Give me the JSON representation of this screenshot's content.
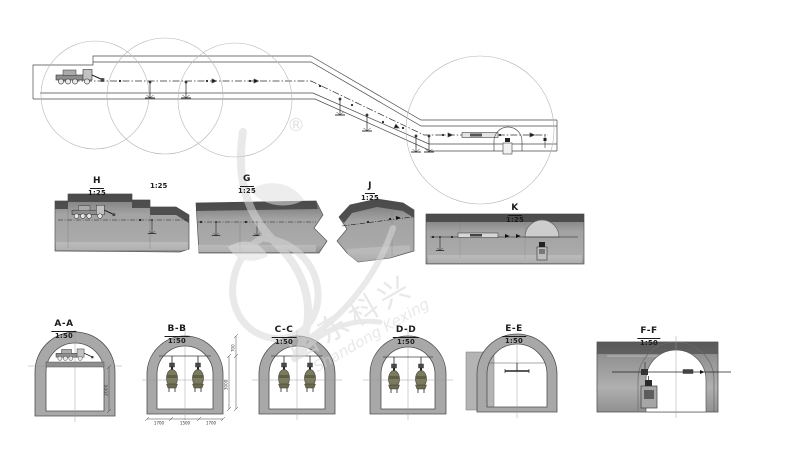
{
  "watermark": {
    "registered_mark": "®",
    "brand_cn": "山东科兴",
    "brand_en": "Shandong Kexing"
  },
  "detail_views": [
    {
      "label": "H",
      "scale": "1:25"
    },
    {
      "label": "G",
      "scale": "1:25"
    },
    {
      "label": "J",
      "scale": "1:25"
    },
    {
      "label": "K",
      "scale": "1:25"
    }
  ],
  "floating_scale": "1:25",
  "cross_sections": [
    {
      "label": "A-A",
      "scale": "1:50"
    },
    {
      "label": "B-B",
      "scale": "1:50"
    },
    {
      "label": "C-C",
      "scale": "1:50"
    },
    {
      "label": "D-D",
      "scale": "1:50"
    },
    {
      "label": "E-E",
      "scale": "1:50"
    },
    {
      "label": "F-F",
      "scale": "1:50"
    }
  ],
  "dimensions": {
    "aa_platform_height": "2000",
    "bb_height_total": "3000",
    "bb_height_upper": "700",
    "bb_width_left": "1700",
    "bb_width_center": "1500",
    "bb_width_right": "1700"
  },
  "colors": {
    "paper": "#ffffff",
    "line": "#3a3a3a",
    "concrete_gray": "#a8a8a8",
    "watermark": "#d9d9d9",
    "equipment_olive": "#7b7b60"
  }
}
